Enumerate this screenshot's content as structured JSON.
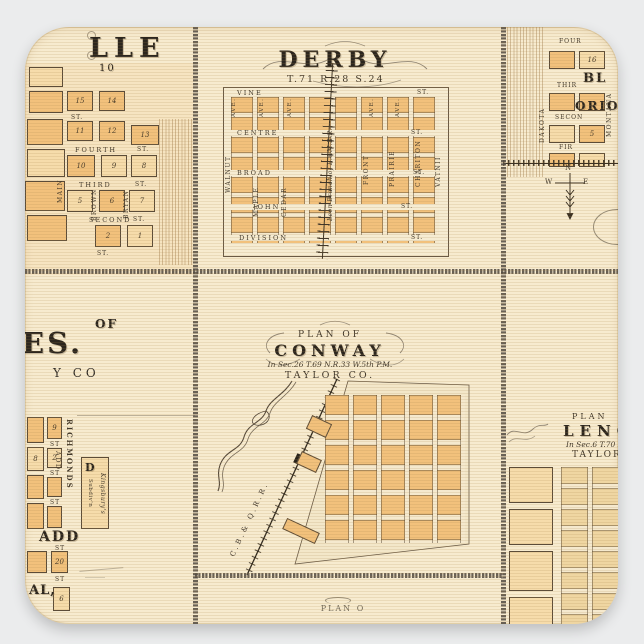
{
  "product": {
    "background_color": "#ebeced"
  },
  "sheet": {
    "paper_color": "#f7ebcf",
    "block_orange": "#f2c17c",
    "block_pale": "#f6dcab",
    "ink": "#3a3127",
    "chain_color": "#564e44"
  },
  "town_topleft": {
    "name_fragment": "LLE",
    "number_fragment": "10",
    "streets": {
      "fourth": "FOURTH",
      "third": "THIRD",
      "second": "SECOND",
      "main": "MAIN",
      "brown": "BROWN",
      "bryan": "BRYAN",
      "st_abbr": "ST."
    },
    "blocks": {
      "row1": [
        "15",
        "14"
      ],
      "row2": [
        "11",
        "12",
        "13"
      ],
      "row3": [
        "10",
        "9",
        "8"
      ],
      "row4": [
        "5",
        "6",
        "7"
      ],
      "row5": [
        "2",
        "1"
      ]
    }
  },
  "town_derby": {
    "title": "DERBY",
    "township": "T.71 R.28 S.24",
    "streets": {
      "vine": "VINE",
      "centre": "CENTRE",
      "broad": "BROAD",
      "john": "JOHN",
      "division": "DIVISION",
      "st_abbr": "ST."
    },
    "avenues": {
      "walnut": "WALNUT",
      "maple": "MAPLE",
      "cedar": "CEDAR",
      "front": "FRONT",
      "prairie": "PRAIRIE",
      "chariton": "CHARITON",
      "east": "VATNII",
      "ave_abbr": "AVE."
    },
    "railroad": "Leon Branch of B.&M.R.R."
  },
  "town_topright": {
    "name_fragments": {
      "line1": "BL",
      "line2": "ORIO"
    },
    "streets": {
      "fourth": "FOUR",
      "third": "THIR",
      "second": "SECON",
      "first": "FIR",
      "dakota": "DAKOTA",
      "montana": "MONTANA"
    },
    "blocks": [
      "16",
      "5"
    ],
    "compass": {
      "n": "N",
      "w": "W",
      "e": "E"
    }
  },
  "town_midleft": {
    "title_fragments": {
      "of": "OF",
      "name": "ES.",
      "county": "Y CO"
    },
    "labels": {
      "richmonds": "RICHMONDS",
      "richmonds_add": "ADD",
      "block_d": "D",
      "kingsburys": "Kingsbury's",
      "subdivision": "Subdiv'n",
      "add_big": "ADD",
      "al_fragment": "AL,",
      "st_abbr": "ST"
    },
    "blocks": {
      "a": "9",
      "b": "2",
      "c": "8",
      "d": "20",
      "e": "6"
    }
  },
  "town_conway": {
    "plan_of": "PLAN OF",
    "title": "CONWAY",
    "location": "In Sec.26 T.69 N.R.33 W.5th P.M.",
    "county": "TAYLOR CO.",
    "railroad": "C.B.& Q.R.R."
  },
  "town_lenox": {
    "plan_of": "PLAN",
    "title": "LENOX",
    "location": "In Sec.6 T.70 N.",
    "county": "TAYLOR CO."
  },
  "bottom_panel": {
    "fragment": "PLAN O"
  }
}
